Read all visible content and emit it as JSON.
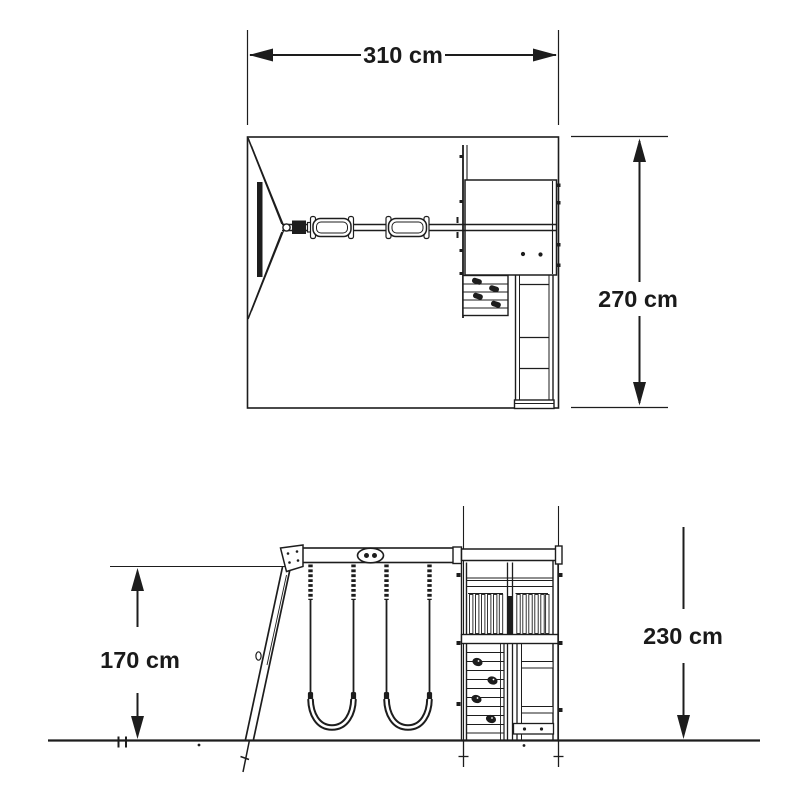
{
  "labels": {
    "plan_width": "310 cm",
    "plan_depth": "270 cm",
    "beam_height": "170 cm",
    "tower_height": "230 cm"
  },
  "colors": {
    "line": "#1d1d1d",
    "text": "#1a1a1a",
    "background": "#ffffff"
  }
}
